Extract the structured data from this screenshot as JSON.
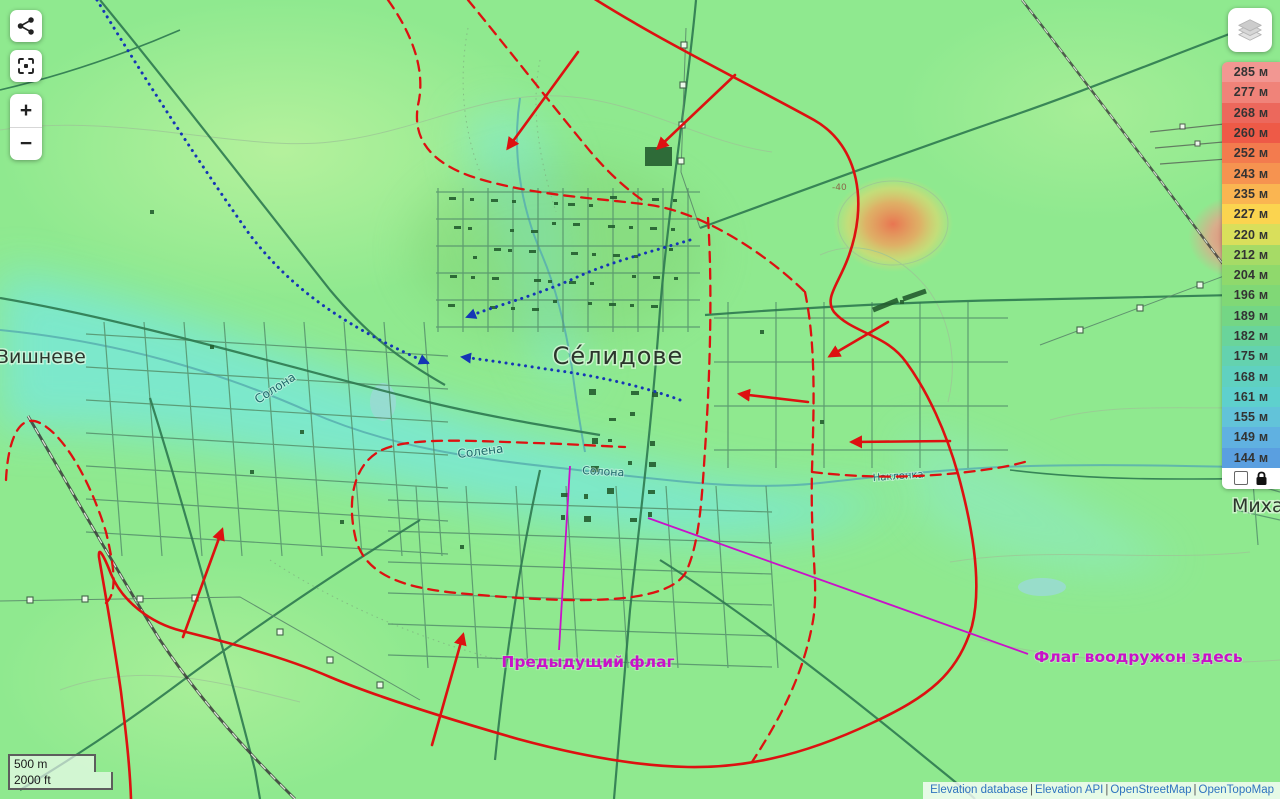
{
  "ui": {
    "controls": {
      "share_icon": "share-icon",
      "locate_icon": "locate-icon",
      "layers_icon": "layers-icon",
      "zoom_in": "+",
      "zoom_out": "−"
    },
    "legend": {
      "items": [
        {
          "label": "285 м",
          "color": "#F29792"
        },
        {
          "label": "277 м",
          "color": "#F08379"
        },
        {
          "label": "268 м",
          "color": "#EC685C"
        },
        {
          "label": "260 м",
          "color": "#EE5A47"
        },
        {
          "label": "252 м",
          "color": "#F37B4E"
        },
        {
          "label": "243 м",
          "color": "#F69350"
        },
        {
          "label": "235 м",
          "color": "#FAB551"
        },
        {
          "label": "227 м",
          "color": "#FBD44F"
        },
        {
          "label": "220 м",
          "color": "#D9DF5B"
        },
        {
          "label": "212 м",
          "color": "#A6DB66"
        },
        {
          "label": "204 м",
          "color": "#8FD96C"
        },
        {
          "label": "196 м",
          "color": "#80D876"
        },
        {
          "label": "189 м",
          "color": "#74D685"
        },
        {
          "label": "182 м",
          "color": "#6AD49B"
        },
        {
          "label": "175 м",
          "color": "#64D2AF"
        },
        {
          "label": "168 м",
          "color": "#60D1C0"
        },
        {
          "label": "161 м",
          "color": "#5ED0CD"
        },
        {
          "label": "155 м",
          "color": "#62C3D9"
        },
        {
          "label": "149 м",
          "color": "#60B1E1"
        },
        {
          "label": "144 м",
          "color": "#5A9FE0"
        }
      ],
      "footer": {
        "lock_icon": "lock-icon",
        "checkbox_checked": false
      }
    },
    "scale": {
      "metric": "500 m",
      "imperial": "2000 ft"
    },
    "attribution": {
      "links": [
        "Elevation database",
        "Elevation API",
        "OpenStreetMap",
        "OpenTopoMap"
      ],
      "separator": " | "
    }
  },
  "map": {
    "labels": {
      "town": "Се́лидове",
      "village_west": "Вишневе",
      "village_east": "Михай",
      "river_a": "Солона",
      "river_b": "Солена",
      "river_c": "Солона",
      "river_d": "Наклонка",
      "contour_mark": "-40"
    },
    "annotations": {
      "previous_flag_label": "Предыдущий флаг",
      "flag_here_label": "Флаг воодружон здесь",
      "colors": {
        "front_line": "#DD1111",
        "dashed_line": "#DD1111",
        "route_dots": "#1535B5",
        "flag_lines": "#C911C9"
      }
    }
  }
}
